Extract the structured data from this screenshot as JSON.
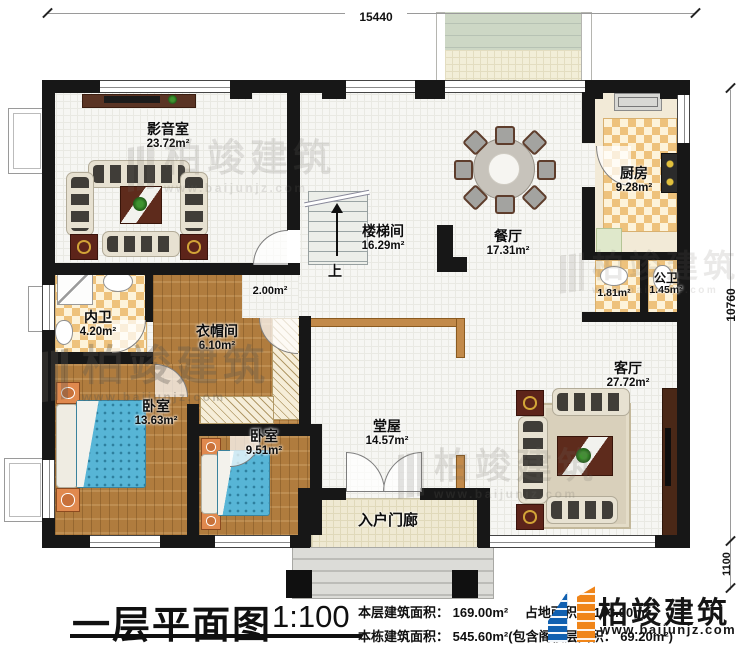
{
  "plan": {
    "title": "一层平面图",
    "scale": "1:100",
    "stats_line1": "本层建筑面积： 169.00m²　 占地面积： 193.00m²",
    "stats_line2": "本栋建筑面积： 545.60m²(包含阁楼层面积： 69.20m²)",
    "dimensions": {
      "top": "15440",
      "right_main": "10760",
      "right_lower": "1100"
    },
    "stairs_up_label": "上",
    "corridor_area": "2.00m²",
    "rooms": [
      {
        "name": "影音室",
        "area": "23.72m²"
      },
      {
        "name": "楼梯间",
        "area": "16.29m²"
      },
      {
        "name": "餐厅",
        "area": "17.31m²"
      },
      {
        "name": "厨房",
        "area": "9.28m²"
      },
      {
        "name": "公卫",
        "area": "1.45m²"
      },
      {
        "name": "",
        "area": "1.81m²"
      },
      {
        "name": "内卫",
        "area": "4.20m²"
      },
      {
        "name": "衣帽间",
        "area": "6.10m²"
      },
      {
        "name": "卧室",
        "area": "13.63m²"
      },
      {
        "name": "卧室",
        "area": "9.51m²"
      },
      {
        "name": "堂屋",
        "area": "14.57m²"
      },
      {
        "name": "客厅",
        "area": "27.72m²"
      },
      {
        "name": "入户门廊",
        "area": ""
      }
    ]
  },
  "brand": {
    "name": "柏竣建筑",
    "url": "www.baijunjz.com"
  },
  "watermark": {
    "name": "柏竣建筑",
    "url": "www.baijunjz.com"
  },
  "colors": {
    "wall": "#171717",
    "wood": "#b07c3e",
    "checker_tile": "#eec27c",
    "bed": "#57b5d6",
    "logo_blue": "#1060b0",
    "logo_orange": "#f08519"
  }
}
